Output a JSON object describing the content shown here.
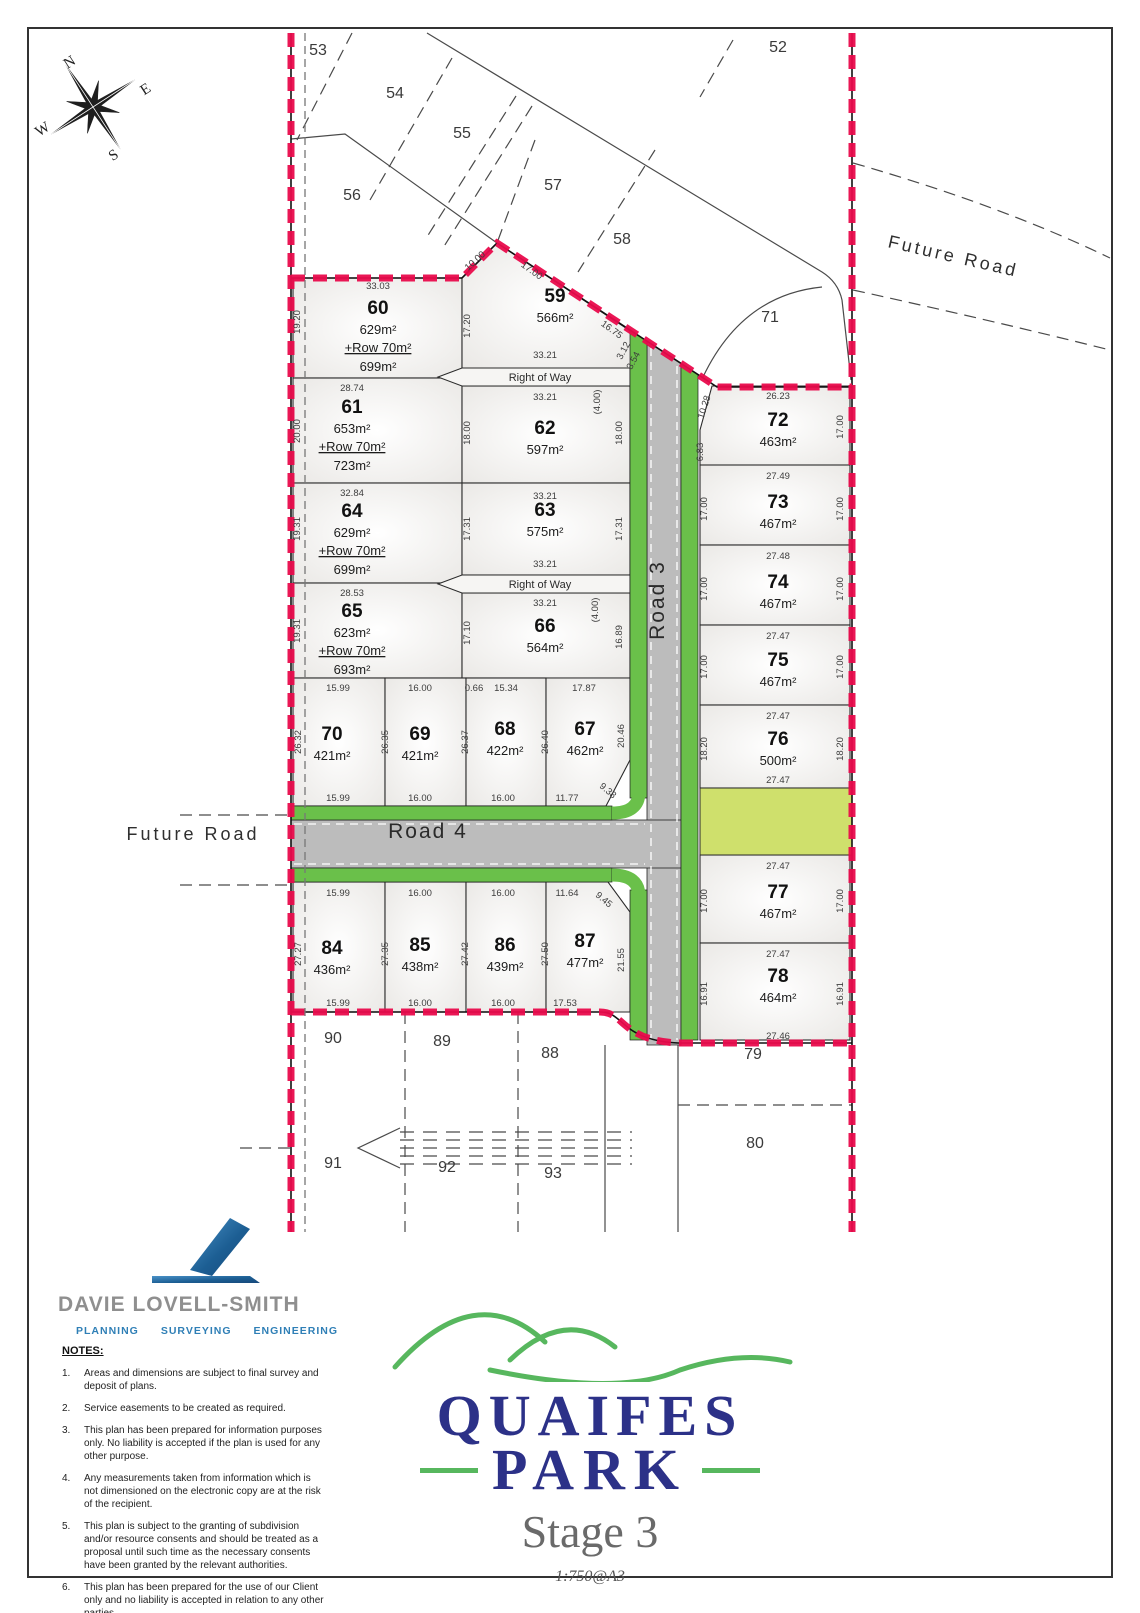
{
  "plan": {
    "compass": {
      "n": "N",
      "e": "E",
      "s": "S",
      "w": "W"
    },
    "roads": {
      "road3": "Road 3",
      "road4": "Road 4",
      "future_road_left": "Future Road",
      "future_road_right": "Future Road",
      "right_of_way_1": "Right of Way",
      "right_of_way_2": "Right of Way"
    },
    "stage_lots": [
      {
        "num": "60",
        "area": "629m²",
        "row": "+Row 70m²",
        "total": "699m²",
        "x": 378,
        "y": 314
      },
      {
        "num": "61",
        "area": "653m²",
        "row": "+Row 70m²",
        "total": "723m²",
        "x": 352,
        "y": 413
      },
      {
        "num": "64",
        "area": "629m²",
        "row": "+Row 70m²",
        "total": "699m²",
        "x": 352,
        "y": 517
      },
      {
        "num": "65",
        "area": "623m²",
        "row": "+Row 70m²",
        "total": "693m²",
        "x": 352,
        "y": 617
      },
      {
        "num": "59",
        "area": "566m²",
        "x": 555,
        "y": 302
      },
      {
        "num": "62",
        "area": "597m²",
        "x": 545,
        "y": 434
      },
      {
        "num": "63",
        "area": "575m²",
        "x": 545,
        "y": 516
      },
      {
        "num": "66",
        "area": "564m²",
        "x": 545,
        "y": 632
      },
      {
        "num": "70",
        "area": "421m²",
        "x": 332,
        "y": 740
      },
      {
        "num": "69",
        "area": "421m²",
        "x": 420,
        "y": 740
      },
      {
        "num": "68",
        "area": "422m²",
        "x": 505,
        "y": 735
      },
      {
        "num": "67",
        "area": "462m²",
        "x": 585,
        "y": 735
      },
      {
        "num": "84",
        "area": "436m²",
        "x": 332,
        "y": 954
      },
      {
        "num": "85",
        "area": "438m²",
        "x": 420,
        "y": 951
      },
      {
        "num": "86",
        "area": "439m²",
        "x": 505,
        "y": 951
      },
      {
        "num": "87",
        "area": "477m²",
        "x": 585,
        "y": 947
      },
      {
        "num": "72",
        "area": "463m²",
        "x": 778,
        "y": 426
      },
      {
        "num": "73",
        "area": "467m²",
        "x": 778,
        "y": 508
      },
      {
        "num": "74",
        "area": "467m²",
        "x": 778,
        "y": 588
      },
      {
        "num": "75",
        "area": "467m²",
        "x": 778,
        "y": 666
      },
      {
        "num": "76",
        "area": "500m²",
        "x": 778,
        "y": 745
      },
      {
        "num": "77",
        "area": "467m²",
        "x": 778,
        "y": 898
      },
      {
        "num": "78",
        "area": "464m²",
        "x": 778,
        "y": 982
      }
    ],
    "adjacent_lots": [
      {
        "num": "53",
        "x": 318,
        "y": 55
      },
      {
        "num": "54",
        "x": 395,
        "y": 98
      },
      {
        "num": "55",
        "x": 462,
        "y": 138
      },
      {
        "num": "56",
        "x": 352,
        "y": 200
      },
      {
        "num": "57",
        "x": 553,
        "y": 190
      },
      {
        "num": "58",
        "x": 622,
        "y": 244
      },
      {
        "num": "52",
        "x": 778,
        "y": 52
      },
      {
        "num": "71",
        "x": 770,
        "y": 322
      },
      {
        "num": "90",
        "x": 333,
        "y": 1043
      },
      {
        "num": "89",
        "x": 442,
        "y": 1046
      },
      {
        "num": "88",
        "x": 550,
        "y": 1058
      },
      {
        "num": "79",
        "x": 753,
        "y": 1059
      },
      {
        "num": "80",
        "x": 755,
        "y": 1148
      },
      {
        "num": "91",
        "x": 333,
        "y": 1168
      },
      {
        "num": "92",
        "x": 447,
        "y": 1172
      },
      {
        "num": "93",
        "x": 553,
        "y": 1178
      }
    ],
    "dimensions": [
      {
        "t": "33.03",
        "x": 378,
        "y": 289,
        "r": 0
      },
      {
        "t": "19.20",
        "x": 300,
        "y": 322,
        "r": -90
      },
      {
        "t": "17.20",
        "x": 470,
        "y": 326,
        "r": -90
      },
      {
        "t": "10.00",
        "x": 477,
        "y": 263,
        "r": -42
      },
      {
        "t": "17.00",
        "x": 530,
        "y": 273,
        "r": 36
      },
      {
        "t": "16.75",
        "x": 610,
        "y": 332,
        "r": 36
      },
      {
        "t": "3.12",
        "x": 626,
        "y": 352,
        "r": -62
      },
      {
        "t": "3.54",
        "x": 636,
        "y": 362,
        "r": -62
      },
      {
        "t": "33.21",
        "x": 545,
        "y": 358,
        "r": 0
      },
      {
        "t": "33.21",
        "x": 545,
        "y": 400,
        "r": 0
      },
      {
        "t": "(4.00)",
        "x": 600,
        "y": 402,
        "r": -90
      },
      {
        "t": "28.74",
        "x": 352,
        "y": 391,
        "r": 0
      },
      {
        "t": "20.00",
        "x": 300,
        "y": 431,
        "r": -90
      },
      {
        "t": "18.00",
        "x": 470,
        "y": 433,
        "r": -90
      },
      {
        "t": "18.00",
        "x": 622,
        "y": 433,
        "r": -90
      },
      {
        "t": "32.84",
        "x": 352,
        "y": 496,
        "r": 0
      },
      {
        "t": "19.31",
        "x": 300,
        "y": 529,
        "r": -90
      },
      {
        "t": "17.31",
        "x": 470,
        "y": 529,
        "r": -90
      },
      {
        "t": "17.31",
        "x": 622,
        "y": 529,
        "r": -90
      },
      {
        "t": "33.21",
        "x": 545,
        "y": 499,
        "r": 0
      },
      {
        "t": "33.21",
        "x": 545,
        "y": 567,
        "r": 0
      },
      {
        "t": "33.21",
        "x": 545,
        "y": 606,
        "r": 0
      },
      {
        "t": "(4.00)",
        "x": 598,
        "y": 610,
        "r": -90
      },
      {
        "t": "28.53",
        "x": 352,
        "y": 596,
        "r": 0
      },
      {
        "t": "19.31",
        "x": 300,
        "y": 631,
        "r": -90
      },
      {
        "t": "17.10",
        "x": 470,
        "y": 633,
        "r": -90
      },
      {
        "t": "16.89",
        "x": 622,
        "y": 637,
        "r": -90
      },
      {
        "t": "15.99",
        "x": 338,
        "y": 691,
        "r": 0
      },
      {
        "t": "16.00",
        "x": 420,
        "y": 691,
        "r": 0
      },
      {
        "t": "0.66",
        "x": 474,
        "y": 691,
        "r": 0
      },
      {
        "t": "15.34",
        "x": 506,
        "y": 691,
        "r": 0
      },
      {
        "t": "17.87",
        "x": 584,
        "y": 691,
        "r": 0
      },
      {
        "t": "26.32",
        "x": 301,
        "y": 742,
        "r": -90
      },
      {
        "t": "26.35",
        "x": 388,
        "y": 742,
        "r": -90
      },
      {
        "t": "26.37",
        "x": 468,
        "y": 742,
        "r": -90
      },
      {
        "t": "26.40",
        "x": 548,
        "y": 742,
        "r": -90
      },
      {
        "t": "20.46",
        "x": 624,
        "y": 736,
        "r": -90
      },
      {
        "t": "15.99",
        "x": 338,
        "y": 801,
        "r": 0
      },
      {
        "t": "16.00",
        "x": 420,
        "y": 801,
        "r": 0
      },
      {
        "t": "16.00",
        "x": 503,
        "y": 801,
        "r": 0
      },
      {
        "t": "11.77",
        "x": 567,
        "y": 801,
        "r": 0
      },
      {
        "t": "9.38",
        "x": 606,
        "y": 793,
        "r": 40
      },
      {
        "t": "15.99",
        "x": 338,
        "y": 896,
        "r": 0
      },
      {
        "t": "16.00",
        "x": 420,
        "y": 896,
        "r": 0
      },
      {
        "t": "16.00",
        "x": 503,
        "y": 896,
        "r": 0
      },
      {
        "t": "11.64",
        "x": 567,
        "y": 896,
        "r": 0
      },
      {
        "t": "9.45",
        "x": 602,
        "y": 902,
        "r": 40
      },
      {
        "t": "27.27",
        "x": 301,
        "y": 954,
        "r": -90
      },
      {
        "t": "27.35",
        "x": 388,
        "y": 954,
        "r": -90
      },
      {
        "t": "27.42",
        "x": 468,
        "y": 954,
        "r": -90
      },
      {
        "t": "27.50",
        "x": 548,
        "y": 954,
        "r": -90
      },
      {
        "t": "21.55",
        "x": 624,
        "y": 960,
        "r": -90
      },
      {
        "t": "15.99",
        "x": 338,
        "y": 1006,
        "r": 0
      },
      {
        "t": "16.00",
        "x": 420,
        "y": 1006,
        "r": 0
      },
      {
        "t": "16.00",
        "x": 503,
        "y": 1006,
        "r": 0
      },
      {
        "t": "17.53",
        "x": 565,
        "y": 1006,
        "r": 0
      },
      {
        "t": "26.23",
        "x": 778,
        "y": 399,
        "r": 0
      },
      {
        "t": "10.28",
        "x": 707,
        "y": 408,
        "r": -72
      },
      {
        "t": "6.83",
        "x": 703,
        "y": 452,
        "r": -90
      },
      {
        "t": "17.00",
        "x": 843,
        "y": 427,
        "r": -90
      },
      {
        "t": "27.49",
        "x": 778,
        "y": 479,
        "r": 0
      },
      {
        "t": "17.00",
        "x": 707,
        "y": 509,
        "r": -90
      },
      {
        "t": "17.00",
        "x": 843,
        "y": 509,
        "r": -90
      },
      {
        "t": "27.48",
        "x": 778,
        "y": 559,
        "r": 0
      },
      {
        "t": "17.00",
        "x": 707,
        "y": 589,
        "r": -90
      },
      {
        "t": "17.00",
        "x": 843,
        "y": 589,
        "r": -90
      },
      {
        "t": "27.47",
        "x": 778,
        "y": 639,
        "r": 0
      },
      {
        "t": "17.00",
        "x": 707,
        "y": 667,
        "r": -90
      },
      {
        "t": "17.00",
        "x": 843,
        "y": 667,
        "r": -90
      },
      {
        "t": "27.47",
        "x": 778,
        "y": 719,
        "r": 0
      },
      {
        "t": "18.20",
        "x": 707,
        "y": 749,
        "r": -90
      },
      {
        "t": "18.20",
        "x": 843,
        "y": 749,
        "r": -90
      },
      {
        "t": "27.47",
        "x": 778,
        "y": 783,
        "r": 0
      },
      {
        "t": "27.47",
        "x": 778,
        "y": 869,
        "r": 0
      },
      {
        "t": "17.00",
        "x": 707,
        "y": 901,
        "r": -90
      },
      {
        "t": "17.00",
        "x": 843,
        "y": 901,
        "r": -90
      },
      {
        "t": "27.47",
        "x": 778,
        "y": 957,
        "r": 0
      },
      {
        "t": "16.91",
        "x": 707,
        "y": 994,
        "r": -90
      },
      {
        "t": "16.91",
        "x": 843,
        "y": 994,
        "r": -90
      },
      {
        "t": "27.46",
        "x": 778,
        "y": 1039,
        "r": 0
      }
    ]
  },
  "branding": {
    "firm_name": "Davie Lovell-Smith",
    "disciplines": [
      "PLANNING",
      "SURVEYING",
      "ENGINEERING"
    ]
  },
  "notes": {
    "heading": "NOTES:",
    "items": [
      "Areas and dimensions are subject to final survey and deposit of plans.",
      "Service easements to be created as required.",
      "This plan has been prepared for information purposes only. No liability is accepted if the plan is used for any other purpose.",
      "Any measurements taken from information which is not dimensioned on the electronic copy are at the risk of the recipient.",
      "This plan is subject to the granting of subdivision and/or resource consents and should be treated as a proposal until such time as the necessary consents have been granted by the relevant authorities.",
      "This plan has been prepared for the use of our Client only and no liability is accepted in relation to any other parties."
    ]
  },
  "title_block": {
    "name_line1": "QUAIFES",
    "name_line2": "PARK",
    "stage": "Stage 3",
    "scale": "1:750@A3"
  },
  "colors": {
    "boundary_red": "#e90b4c",
    "berm_green": "#6ac04a",
    "reserve_green": "#cfe06c",
    "road_grey": "#bcbcbc",
    "brand_navy": "#2c3188",
    "brand_green": "#57b75e",
    "brand_blue": "#2f7fb6"
  }
}
